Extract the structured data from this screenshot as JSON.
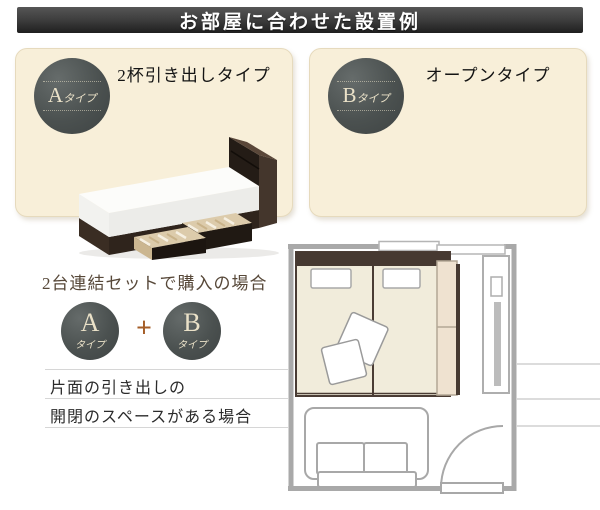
{
  "header": {
    "title": "お部屋に合わせた設置例"
  },
  "cards": [
    {
      "badge_letter": "A",
      "badge_suffix": "タイプ",
      "title": "2杯引き出しタイプ"
    },
    {
      "badge_letter": "B",
      "badge_suffix": "タイプ",
      "title": "オープンタイプ"
    }
  ],
  "combo": {
    "title": "2台連結セットで購入の場合",
    "a_letter": "A",
    "a_suffix": "タイプ",
    "plus": "+",
    "b_letter": "B",
    "b_suffix": "タイプ",
    "note1": "片面の引き出しの",
    "note2": "開閉のスペースがある場合"
  },
  "colors": {
    "header_bg": "#3a3a3a",
    "card_bg": "#f8efd9",
    "badge_circle": "#4b5150",
    "badge_text": "#eae1c8",
    "plus_accent": "#a55e28",
    "bed_frame_dark": "#3a2d23",
    "plan_wall": "#a9a9a9",
    "plan_bed_fill": "#f1ecdb",
    "plan_headboard": "#463931",
    "plan_dresser_fill": "#efe2d0"
  }
}
